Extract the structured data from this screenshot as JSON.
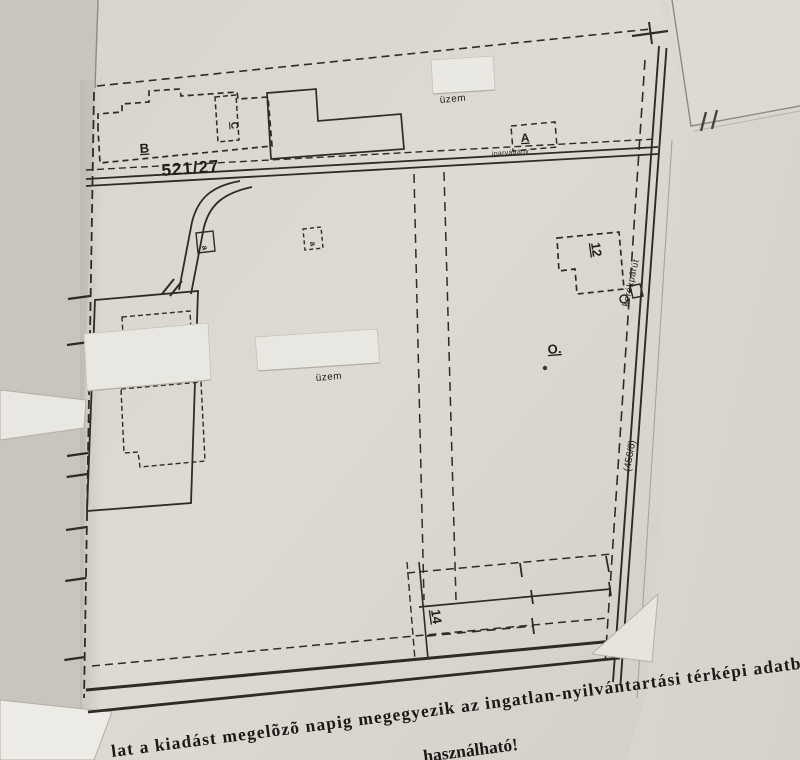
{
  "map_labels": {
    "road_parcel_number": "521/27",
    "road_name": "iparvágány",
    "bike_path": "kerékpárút",
    "parcel_ref_right": "(456/6)",
    "factory_top": "üzem",
    "factory_center": "üzem",
    "building_b": "B",
    "building_c": "C",
    "building_a": "A",
    "building_12": "12",
    "building_14": "14",
    "point_o": "O.",
    "marker_left": "a",
    "marker_right": "a"
  },
  "footer": {
    "line1": "lat a kiadást megelõzõ napig megegyezik az ingatlan-nyilvántartási térképi adatbázis t",
    "line2": "használható!"
  },
  "colors": {
    "paper": "#dcd8d1",
    "paper_bright": "#e9e7e1",
    "ink": "#2e2b26",
    "text_ink": "#1b1916"
  }
}
